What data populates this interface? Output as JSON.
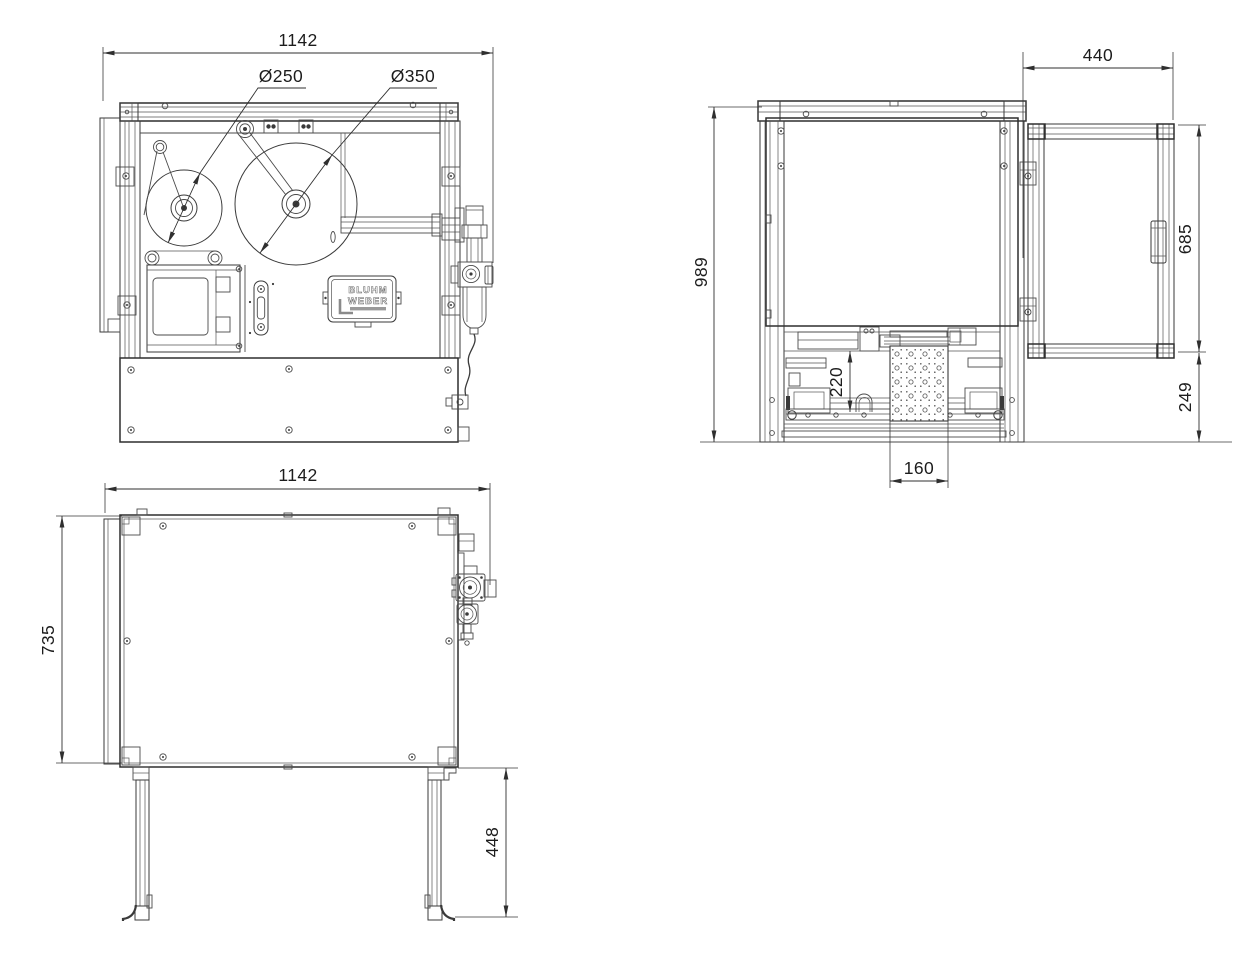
{
  "meta": {
    "background": "#ffffff",
    "ink": "#3a3a3a",
    "drawing_type": "technical-orthographic-views"
  },
  "views": {
    "front": {
      "width_dim": "1142",
      "reel_small_dia": "Ø250",
      "reel_large_dia": "Ø350",
      "logo": {
        "line1": "BLUHM",
        "line2": "WEBER"
      }
    },
    "side": {
      "height_dim": "989",
      "door_width_dim": "440",
      "door_height_dim": "685",
      "base_height_dim": "249",
      "stroke_dim": "220",
      "pad_width_dim": "160"
    },
    "top": {
      "width_dim": "1142",
      "depth_dim": "735",
      "leg_dim": "448"
    }
  }
}
